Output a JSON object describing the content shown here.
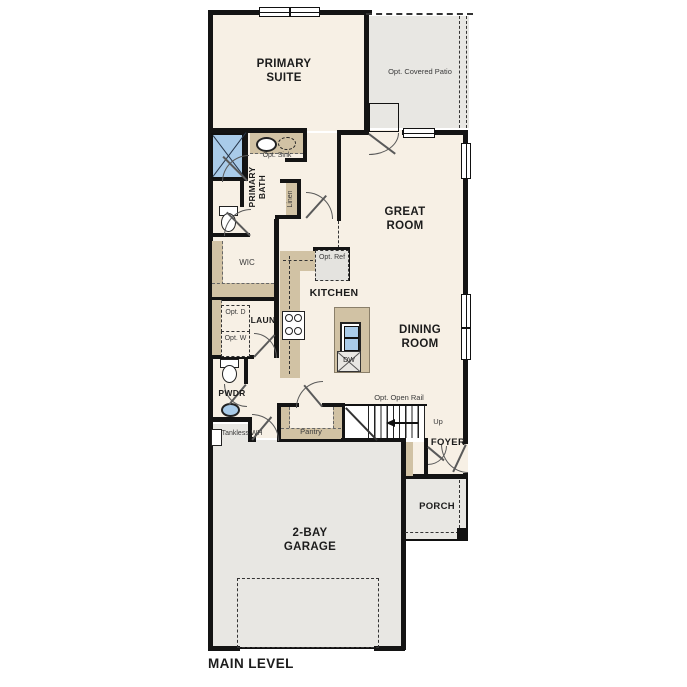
{
  "title": "MAIN LEVEL",
  "rooms": {
    "primary_suite": "PRIMARY SUITE",
    "patio": "Opt. Covered Patio",
    "great_room": "GREAT ROOM",
    "dining_room": "DINING ROOM",
    "kitchen": "KITCHEN",
    "primary_bath": "PRIMARY BATH",
    "wic": "WIC",
    "laundry": "LAUN",
    "powder": "PWDR",
    "pantry": "Pantry",
    "foyer": "FOYER",
    "porch": "PORCH",
    "garage": "2-BAY GARAGE"
  },
  "annotations": {
    "opt_sink": "Opt. Sink",
    "linen": "Linen",
    "opt_ref": "Opt. Ref",
    "dishwasher": "DW",
    "opt_dryer": "Opt. D",
    "opt_washer": "Opt. W",
    "tankless_wh": "Tankless WH",
    "opt_open_rail": "Opt. Open Rail",
    "stairs_up": "Up"
  },
  "colors": {
    "interior": "#f7f0e5",
    "concrete": "#e8e7e3",
    "cabinet": "#d1c2a4",
    "fixture_blue": "#a9cbe9",
    "wall": "#141414",
    "label": "#1c1c1c",
    "small_label": "#3a3a3a"
  }
}
